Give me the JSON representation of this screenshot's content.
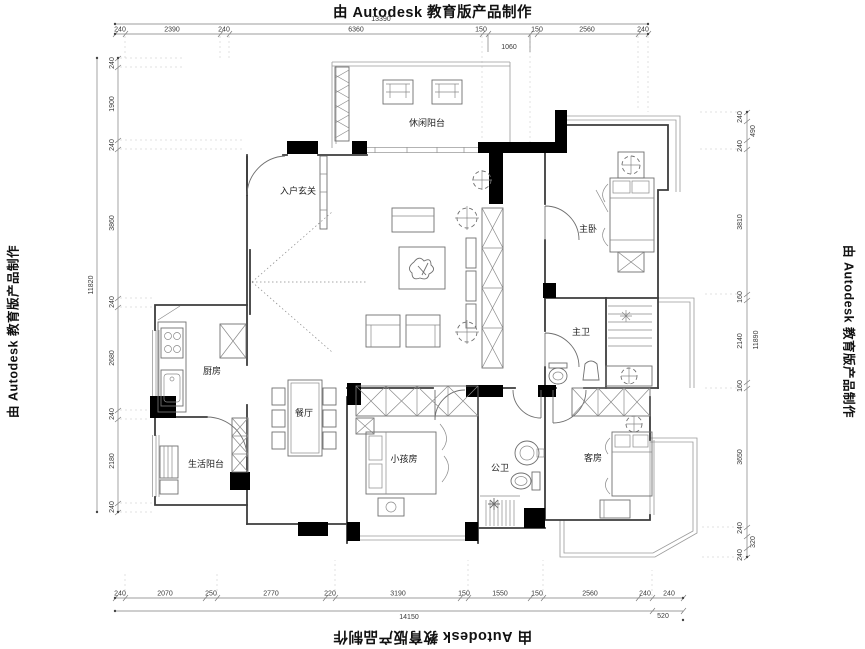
{
  "watermark": {
    "text": "由 Autodesk 教育版产品制作"
  },
  "rooms": {
    "leisure_balcony": "休闲阳台",
    "entry_foyer": "入户玄关",
    "master_bedroom": "主卧",
    "master_bath": "主卫",
    "kitchen": "厨房",
    "dining_room": "餐厅",
    "utility_balcony": "生活阳台",
    "kids_room": "小孩房",
    "guest_bath": "公卫",
    "guest_room": "客房"
  },
  "dims": {
    "top": {
      "total": "13390",
      "segments": [
        "240",
        "2390",
        "240",
        "6360",
        "150",
        "1060",
        "150",
        "2560",
        "240"
      ]
    },
    "bottom": {
      "total": "14150",
      "extra": "520",
      "segments": [
        "240",
        "2070",
        "250",
        "2770",
        "220",
        "3190",
        "150",
        "1550",
        "150",
        "2560",
        "240",
        "240"
      ]
    },
    "left": {
      "total": "11820",
      "segments": [
        "240",
        "1900",
        "240",
        "3860",
        "240",
        "2680",
        "240",
        "2180",
        "240"
      ]
    },
    "right": {
      "total": "11890",
      "segments": [
        "240",
        "490",
        "240",
        "3810",
        "160",
        "2140",
        "160",
        "3650",
        "240",
        "320",
        "240"
      ]
    }
  }
}
